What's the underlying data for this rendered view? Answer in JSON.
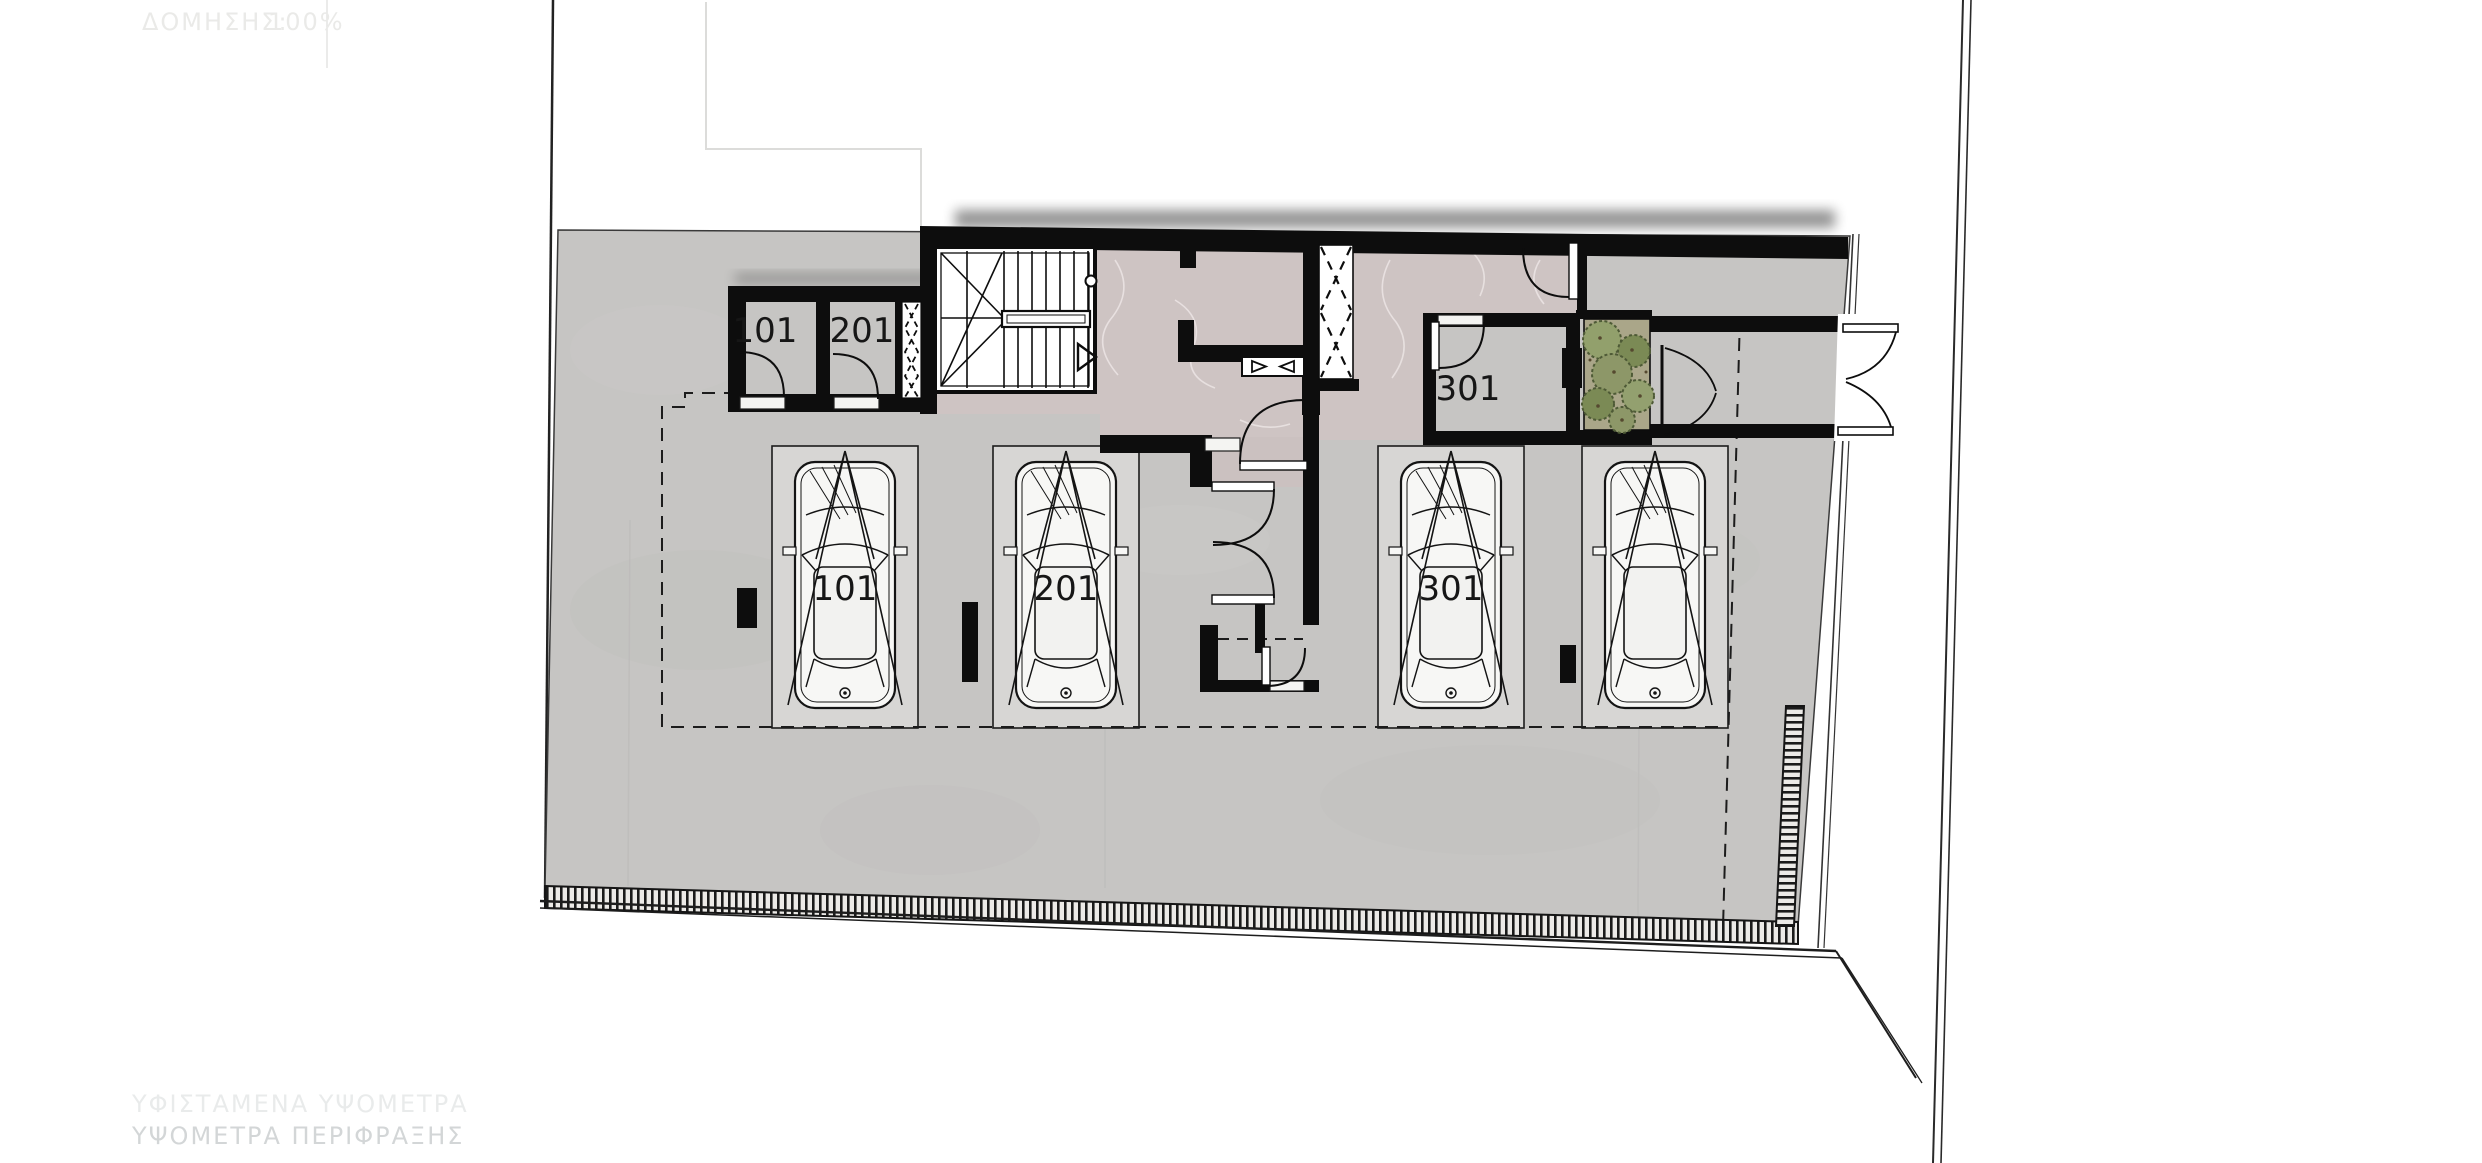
{
  "plan": {
    "type": "architectural-floor-plan",
    "floor": "ground-floor-parking",
    "storage_rooms": [
      {
        "label": "101"
      },
      {
        "label": "201"
      },
      {
        "label": "301"
      }
    ],
    "parking_spaces": [
      {
        "label": "101"
      },
      {
        "label": "201"
      },
      {
        "label": "301"
      },
      {
        "label": ""
      }
    ],
    "annotations": {
      "top_left_coeff": "ΔΟΜΗΣΗΣ:",
      "top_left_value": "100%",
      "bottom_line1": "ΥΦΙΣΤΑΜΕΝΑ ΥΨΟΜΕΤΡΑ",
      "bottom_line2": "ΥΨΟΜΕΤΡΑ ΠΕΡΙΦΡΑΞΗΣ"
    },
    "colors": {
      "background": "#ffffff",
      "concrete": "#c6c5c3",
      "parking_stall": "#d7d6d4",
      "marble_lobby": "#cec4c3",
      "wall": "#0d0d0d",
      "planter_green": "#8d9768",
      "planter_soil": "#aaa689",
      "faint_text": "#d3d6d7"
    }
  }
}
